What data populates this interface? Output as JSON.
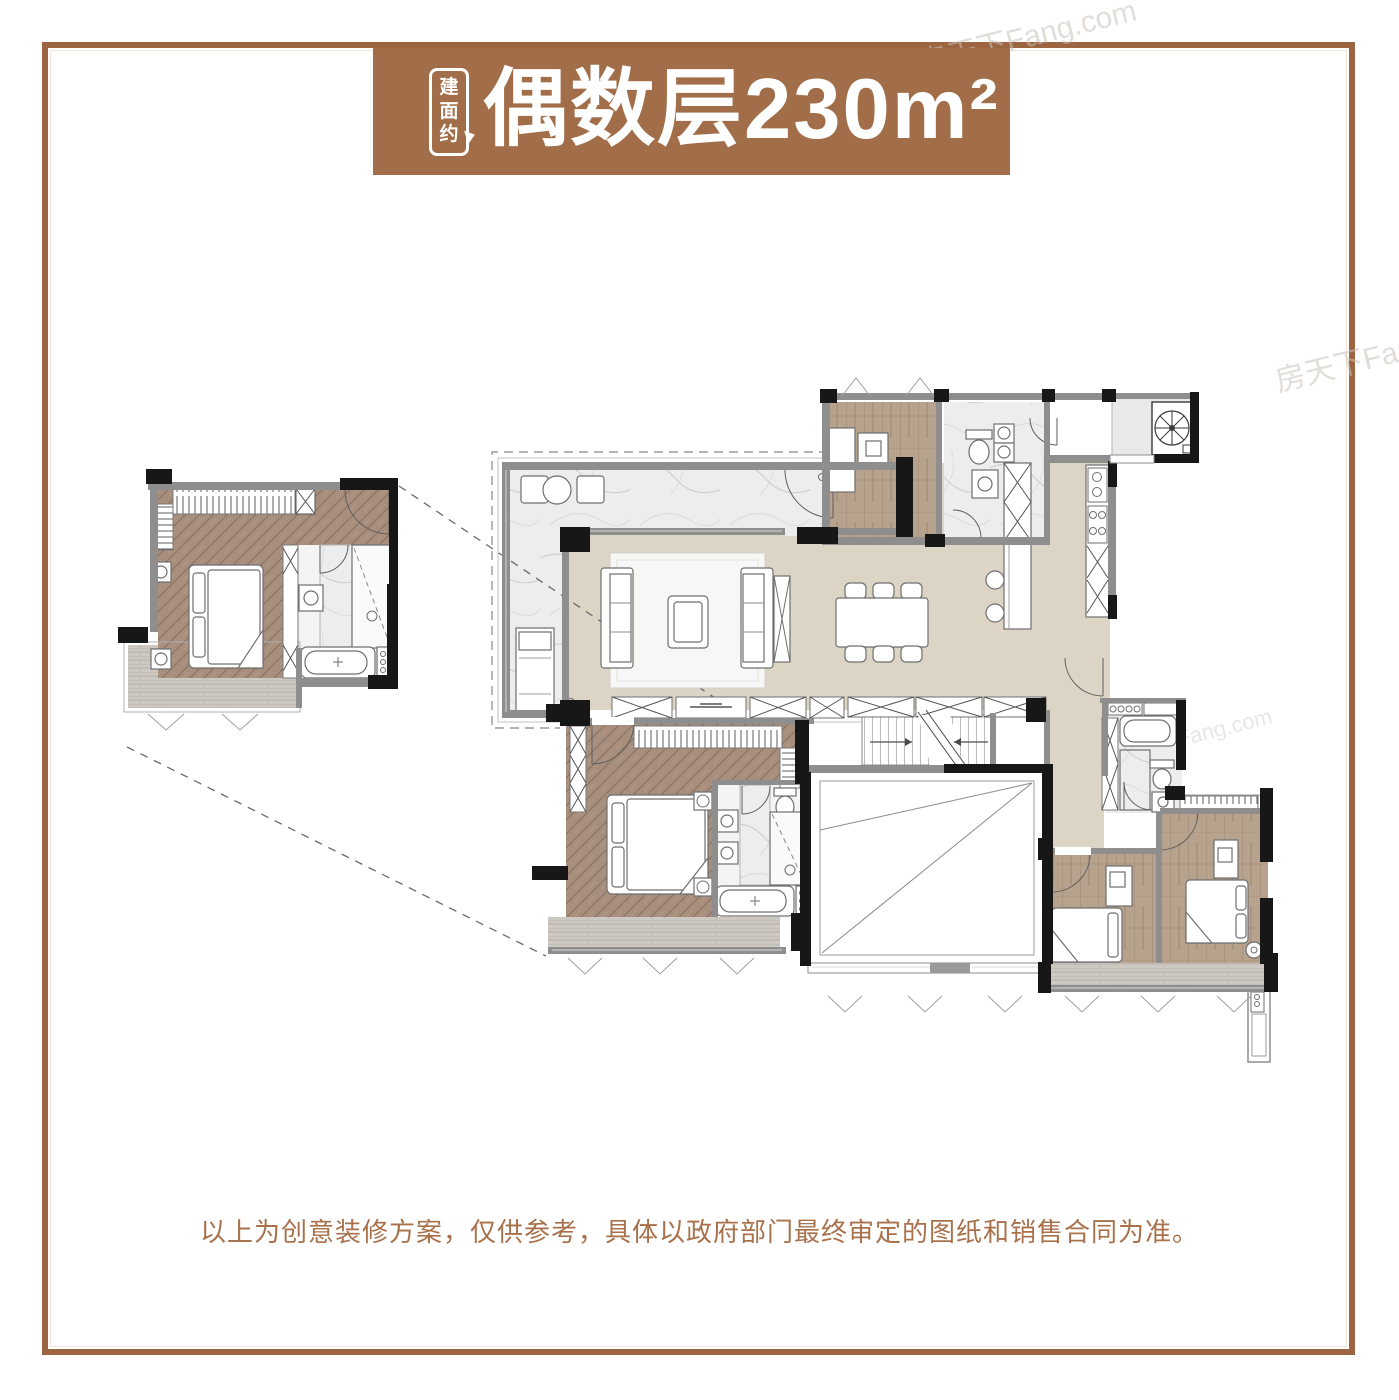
{
  "banner": {
    "badge_chars": [
      "建",
      "面",
      "约"
    ],
    "title": "偶数层230m²",
    "bg_color": "#a26e49",
    "text_color": "#ffffff"
  },
  "frame": {
    "border_color": "#9c6441"
  },
  "watermarks": [
    {
      "text": "房天下Fang.com"
    },
    {
      "text": "房天下Fang.com"
    },
    {
      "text": "房天下Fang.com"
    }
  ],
  "disclaimer": {
    "text": "以上为创意装修方案，仅供参考，具体以政府部门最终审定的图纸和销售合同为准。",
    "color": "#a9714b"
  },
  "palette": {
    "wall_black": "#171717",
    "wall_gray": "#8e8e8e",
    "floor_beige": "#dcd5c5",
    "marble": "#ededed",
    "herringbone_wood": "#a88f7d",
    "plank_wood": "#b7a38d",
    "balcony_deck": "#cdc9c2",
    "paper": "#ffffff"
  }
}
